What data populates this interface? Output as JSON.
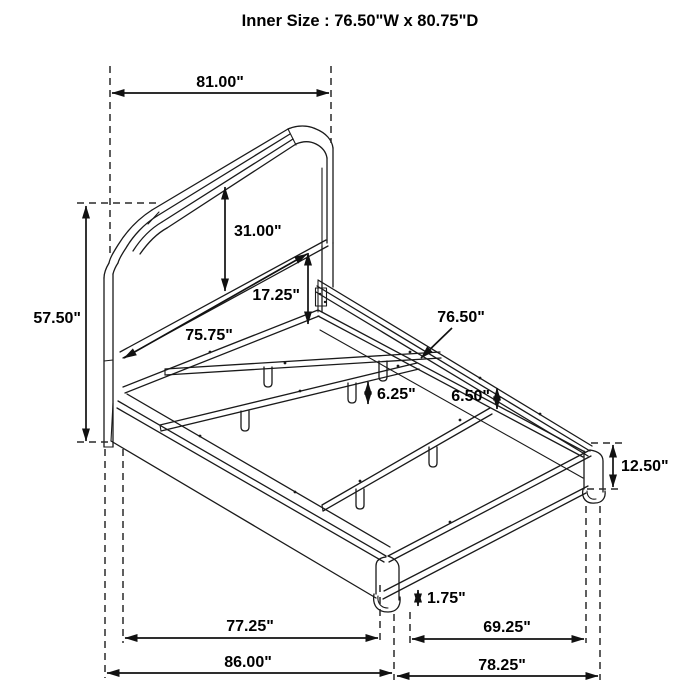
{
  "title": "Inner Size : 76.50\"W x 80.75\"D",
  "dims": {
    "w81": "81.00\"",
    "h5750": "57.50\"",
    "h3100": "31.00\"",
    "h1725": "17.25\"",
    "w7575": "75.75\"",
    "w7650": "76.50\"",
    "h650": "6.50\"",
    "h625": "6.25\"",
    "h1250": "12.50\"",
    "h175": "1.75\"",
    "w7725": "77.25\"",
    "w8600": "86.00\"",
    "d6925": "69.25\"",
    "d7825": "78.25\""
  }
}
